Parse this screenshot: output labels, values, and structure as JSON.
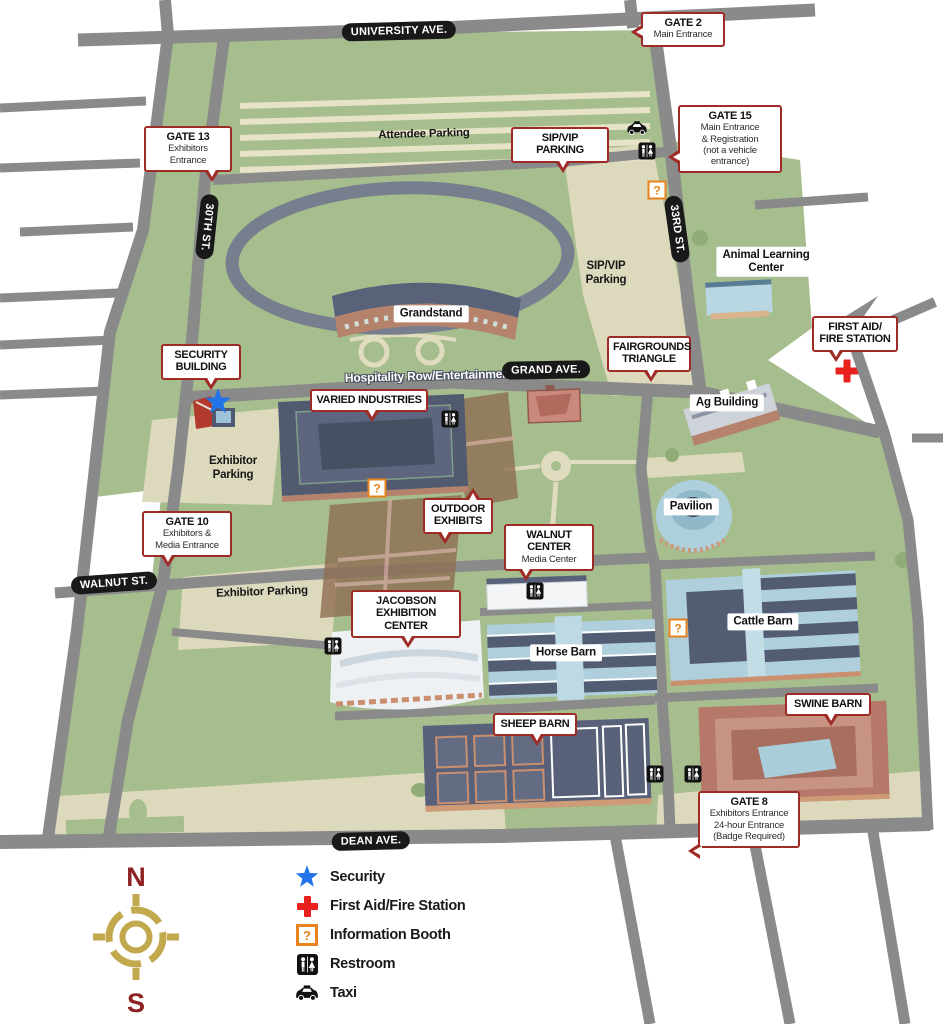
{
  "streets": {
    "university": "UNIVERSITY AVE.",
    "thirtieth": "30TH ST.",
    "thirty_third": "33RD ST.",
    "grand": "GRAND AVE.",
    "walnut": "WALNUT ST.",
    "dean": "DEAN AVE."
  },
  "callouts": {
    "gate2": {
      "title": "GATE 2",
      "subtitle": "Main Entrance"
    },
    "gate13": {
      "title": "GATE 13",
      "subtitle": "Exhibitors Entrance"
    },
    "sip_vip": {
      "title": "SIP/VIP PARKING"
    },
    "gate15": {
      "title": "GATE 15",
      "subtitle": "Main Entrance\n& Registration\n(not a vehicle entrance)"
    },
    "first_aid": {
      "title": "FIRST AID/\nFIRE STATION"
    },
    "security_building": {
      "title": "SECURITY\nBUILDING"
    },
    "fairgrounds_triangle": {
      "title": "FAIRGROUNDS\nTRIANGLE"
    },
    "varied_industries": {
      "title": "VARIED INDUSTRIES"
    },
    "outdoor_exhibits": {
      "title": "OUTDOOR\nEXHIBITS"
    },
    "walnut_center": {
      "title": "WALNUT CENTER",
      "subtitle": "Media Center"
    },
    "gate10": {
      "title": "GATE 10",
      "subtitle": "Exhibitors &\nMedia Entrance"
    },
    "jacobson": {
      "title": "JACOBSON\nEXHIBITION CENTER"
    },
    "sheep_barn": {
      "title": "SHEEP BARN"
    },
    "swine_barn": {
      "title": "SWINE BARN"
    },
    "gate8": {
      "title": "GATE 8",
      "subtitle": "Exhibitors Entrance\n24-hour Entrance\n(Badge Required)"
    }
  },
  "building_labels": {
    "grandstand": "Grandstand",
    "animal_learning_center": "Animal Learning\nCenter",
    "ag_building": "Ag Building",
    "pavilion": "Pavilion",
    "cattle_barn": "Cattle Barn",
    "horse_barn": "Horse Barn"
  },
  "area_labels": {
    "attendee_parking": "Attendee Parking",
    "sip_vip_parking": "SIP/VIP\nParking",
    "hospitality_row": "Hospitality Row/Entertainment",
    "exhibitor_parking_west": "Exhibitor\nParking",
    "exhibitor_parking_south": "Exhibitor Parking"
  },
  "legend": {
    "items": [
      {
        "icon": "security-star",
        "label": "Security"
      },
      {
        "icon": "first-aid-cross",
        "label": "First Aid/Fire Station"
      },
      {
        "icon": "information-booth",
        "label": "Information Booth"
      },
      {
        "icon": "restroom",
        "label": "Restroom"
      },
      {
        "icon": "taxi",
        "label": "Taxi"
      }
    ]
  },
  "compass": {
    "north": "N",
    "south": "S"
  },
  "icons": {
    "info_glyph": "?"
  },
  "colors": {
    "map_green": "#a6bd8d",
    "road_gray": "#8a8a8a",
    "path_cream": "#e0dcbf",
    "callout_border": "#9e2b25",
    "street_label_bg": "#191919",
    "security_blue": "#2273e8",
    "first_aid_red": "#e8211f",
    "info_orange": "#e8821e",
    "compass_gold": "#c2a94e",
    "compass_letter_red": "#8e2121"
  }
}
